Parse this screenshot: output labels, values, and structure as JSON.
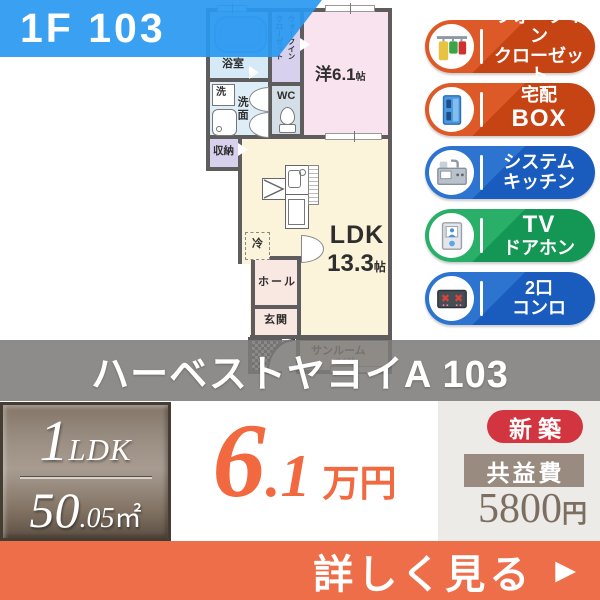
{
  "unit_label": "1F 103",
  "building_name": "ハーベストヤヨイA 103",
  "floorplan": {
    "bath": "浴室",
    "washer": "洗",
    "washroom": "洗面",
    "wc": "WC",
    "wic_vertical": "ウォークイン\nクローゼット",
    "western_room": "洋6.1",
    "western_unit": "帖",
    "storage": "収納",
    "fridge": "冷",
    "ldk_label": "LDK",
    "ldk_size": "13.3",
    "ldk_unit": "帖",
    "hall": "ホール",
    "entrance": "玄関",
    "sunroom": "サンルーム",
    "sunroom_size": "2.1帖"
  },
  "features": [
    {
      "line1": "ウォークイン",
      "line2": "クローゼット",
      "icon": "walk-in-closet",
      "color": "#c64314"
    },
    {
      "line1": "宅配",
      "line2": "BOX",
      "icon": "delivery-box",
      "color": "#c64314"
    },
    {
      "line1": "システム",
      "line2": "キッチン",
      "icon": "system-kitchen",
      "color": "#1a5cbe"
    },
    {
      "line1": "TV",
      "line2": "ドアホン",
      "icon": "tv-doorphone",
      "color": "#149655"
    },
    {
      "line1": "2口",
      "line2": "コンロ",
      "icon": "two-burner-stove",
      "color": "#1a5cbe"
    }
  ],
  "summary": {
    "layout_number": "1",
    "layout_type": "LDK",
    "area_whole": "50",
    "area_fraction": ".05",
    "area_unit": "㎡",
    "rent_whole": "6",
    "rent_fraction": ".1",
    "rent_unit": "万円",
    "new_badge": "新築",
    "fee_label": "共益費",
    "fee_value": "5800",
    "fee_unit": "円"
  },
  "cta": {
    "label": "詳しく見る",
    "arrow": "▶"
  },
  "colors": {
    "unit_banner_blue": "#2998f1",
    "name_banner_gray": "#7e7c7a",
    "price_orange": "#f2683f",
    "new_badge_red": "#d23540",
    "fee_box_taupe": "#998b80",
    "fee_text_brown": "#7c6e60",
    "cta_orange": "#ee6e49",
    "feature_orange": "#c64314",
    "feature_blue": "#1a5cbe",
    "feature_green": "#149655",
    "plan_wall_gray": "#5e5c5d"
  }
}
